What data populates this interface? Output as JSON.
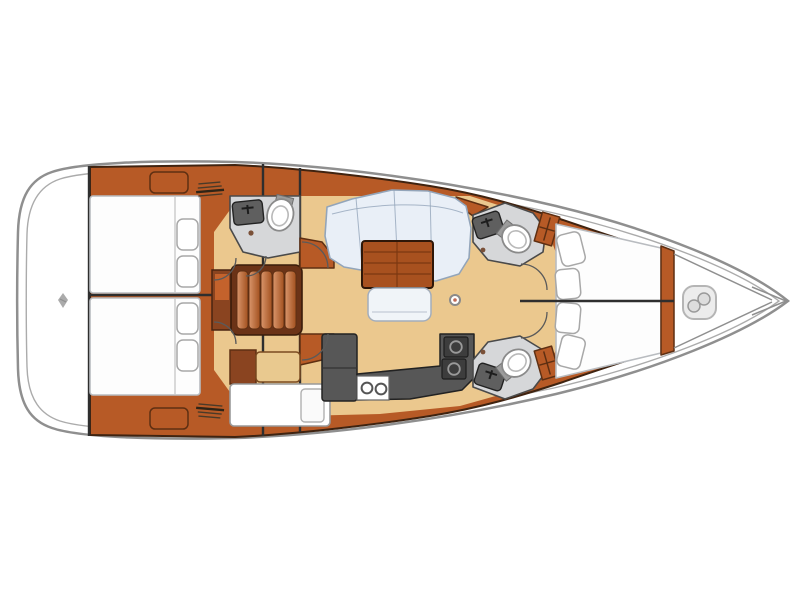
{
  "meta": {
    "description": "Top-down interior layout plan of a sailing yacht, bow pointing right",
    "visible_text": "none"
  },
  "palette": {
    "page_bg": "#ffffff",
    "hull_fill": "#ffffff",
    "hull_stroke": "#8f8f8f",
    "outline": "#3f2310",
    "wood": "#b75a26",
    "wood_dark": "#8a4420",
    "wood_edge": "#5e2f12",
    "floor": "#ebc88e",
    "cushion": "#e9eff7",
    "cushion_stroke": "#93a5ba",
    "mattress": "#fdfdfd",
    "mattress_stroke": "#b9bcc0",
    "table": "#a8511f",
    "table_line": "#7c3812",
    "counter": "#575757",
    "head_floor": "#d6d7d9",
    "fixture_stroke": "#8a8a8a",
    "step_light": "#d9956b",
    "step_dark": "#a2511f",
    "line_dark": "#2e2e2e"
  },
  "rooms": [
    {
      "id": "stern-platform",
      "label": "Stern swim platform"
    },
    {
      "id": "aft-cabin-top",
      "label": "Aft double cabin (port)"
    },
    {
      "id": "aft-cabin-bottom",
      "label": "Aft double cabin (starboard)"
    },
    {
      "id": "aft-head",
      "label": "Aft head with toilet and sink"
    },
    {
      "id": "companionway",
      "label": "Companionway steps"
    },
    {
      "id": "nav-station",
      "label": "Chart table / nav station"
    },
    {
      "id": "salon",
      "label": "Salon with L-settee and table"
    },
    {
      "id": "galley",
      "label": "Galley with double sink and stove"
    },
    {
      "id": "forward-head-top",
      "label": "Forward head (port)"
    },
    {
      "id": "forward-head-bottom",
      "label": "Forward head (starboard)"
    },
    {
      "id": "forward-cabin",
      "label": "Forward V-berth cabin"
    },
    {
      "id": "anchor-locker",
      "label": "Bow anchor locker"
    }
  ],
  "icons": [
    {
      "name": "builder-logo-icon",
      "meaning": "small builder logo glyph on stern platform"
    },
    {
      "name": "vent-hatch-icon",
      "meaning": "hatched vent/step marking on side deck (top and bottom)"
    },
    {
      "name": "windlass-icon",
      "meaning": "anchor windlass glyph in bow locker"
    }
  ],
  "fixtures": {
    "toilets": 3,
    "sinks_bathroom": 3,
    "galley_sinks": 2,
    "stove_burners": 2,
    "beds": 3,
    "pillows_aft_per_bed": 2,
    "pillows_forward": 4,
    "companionway_treads": 5
  }
}
